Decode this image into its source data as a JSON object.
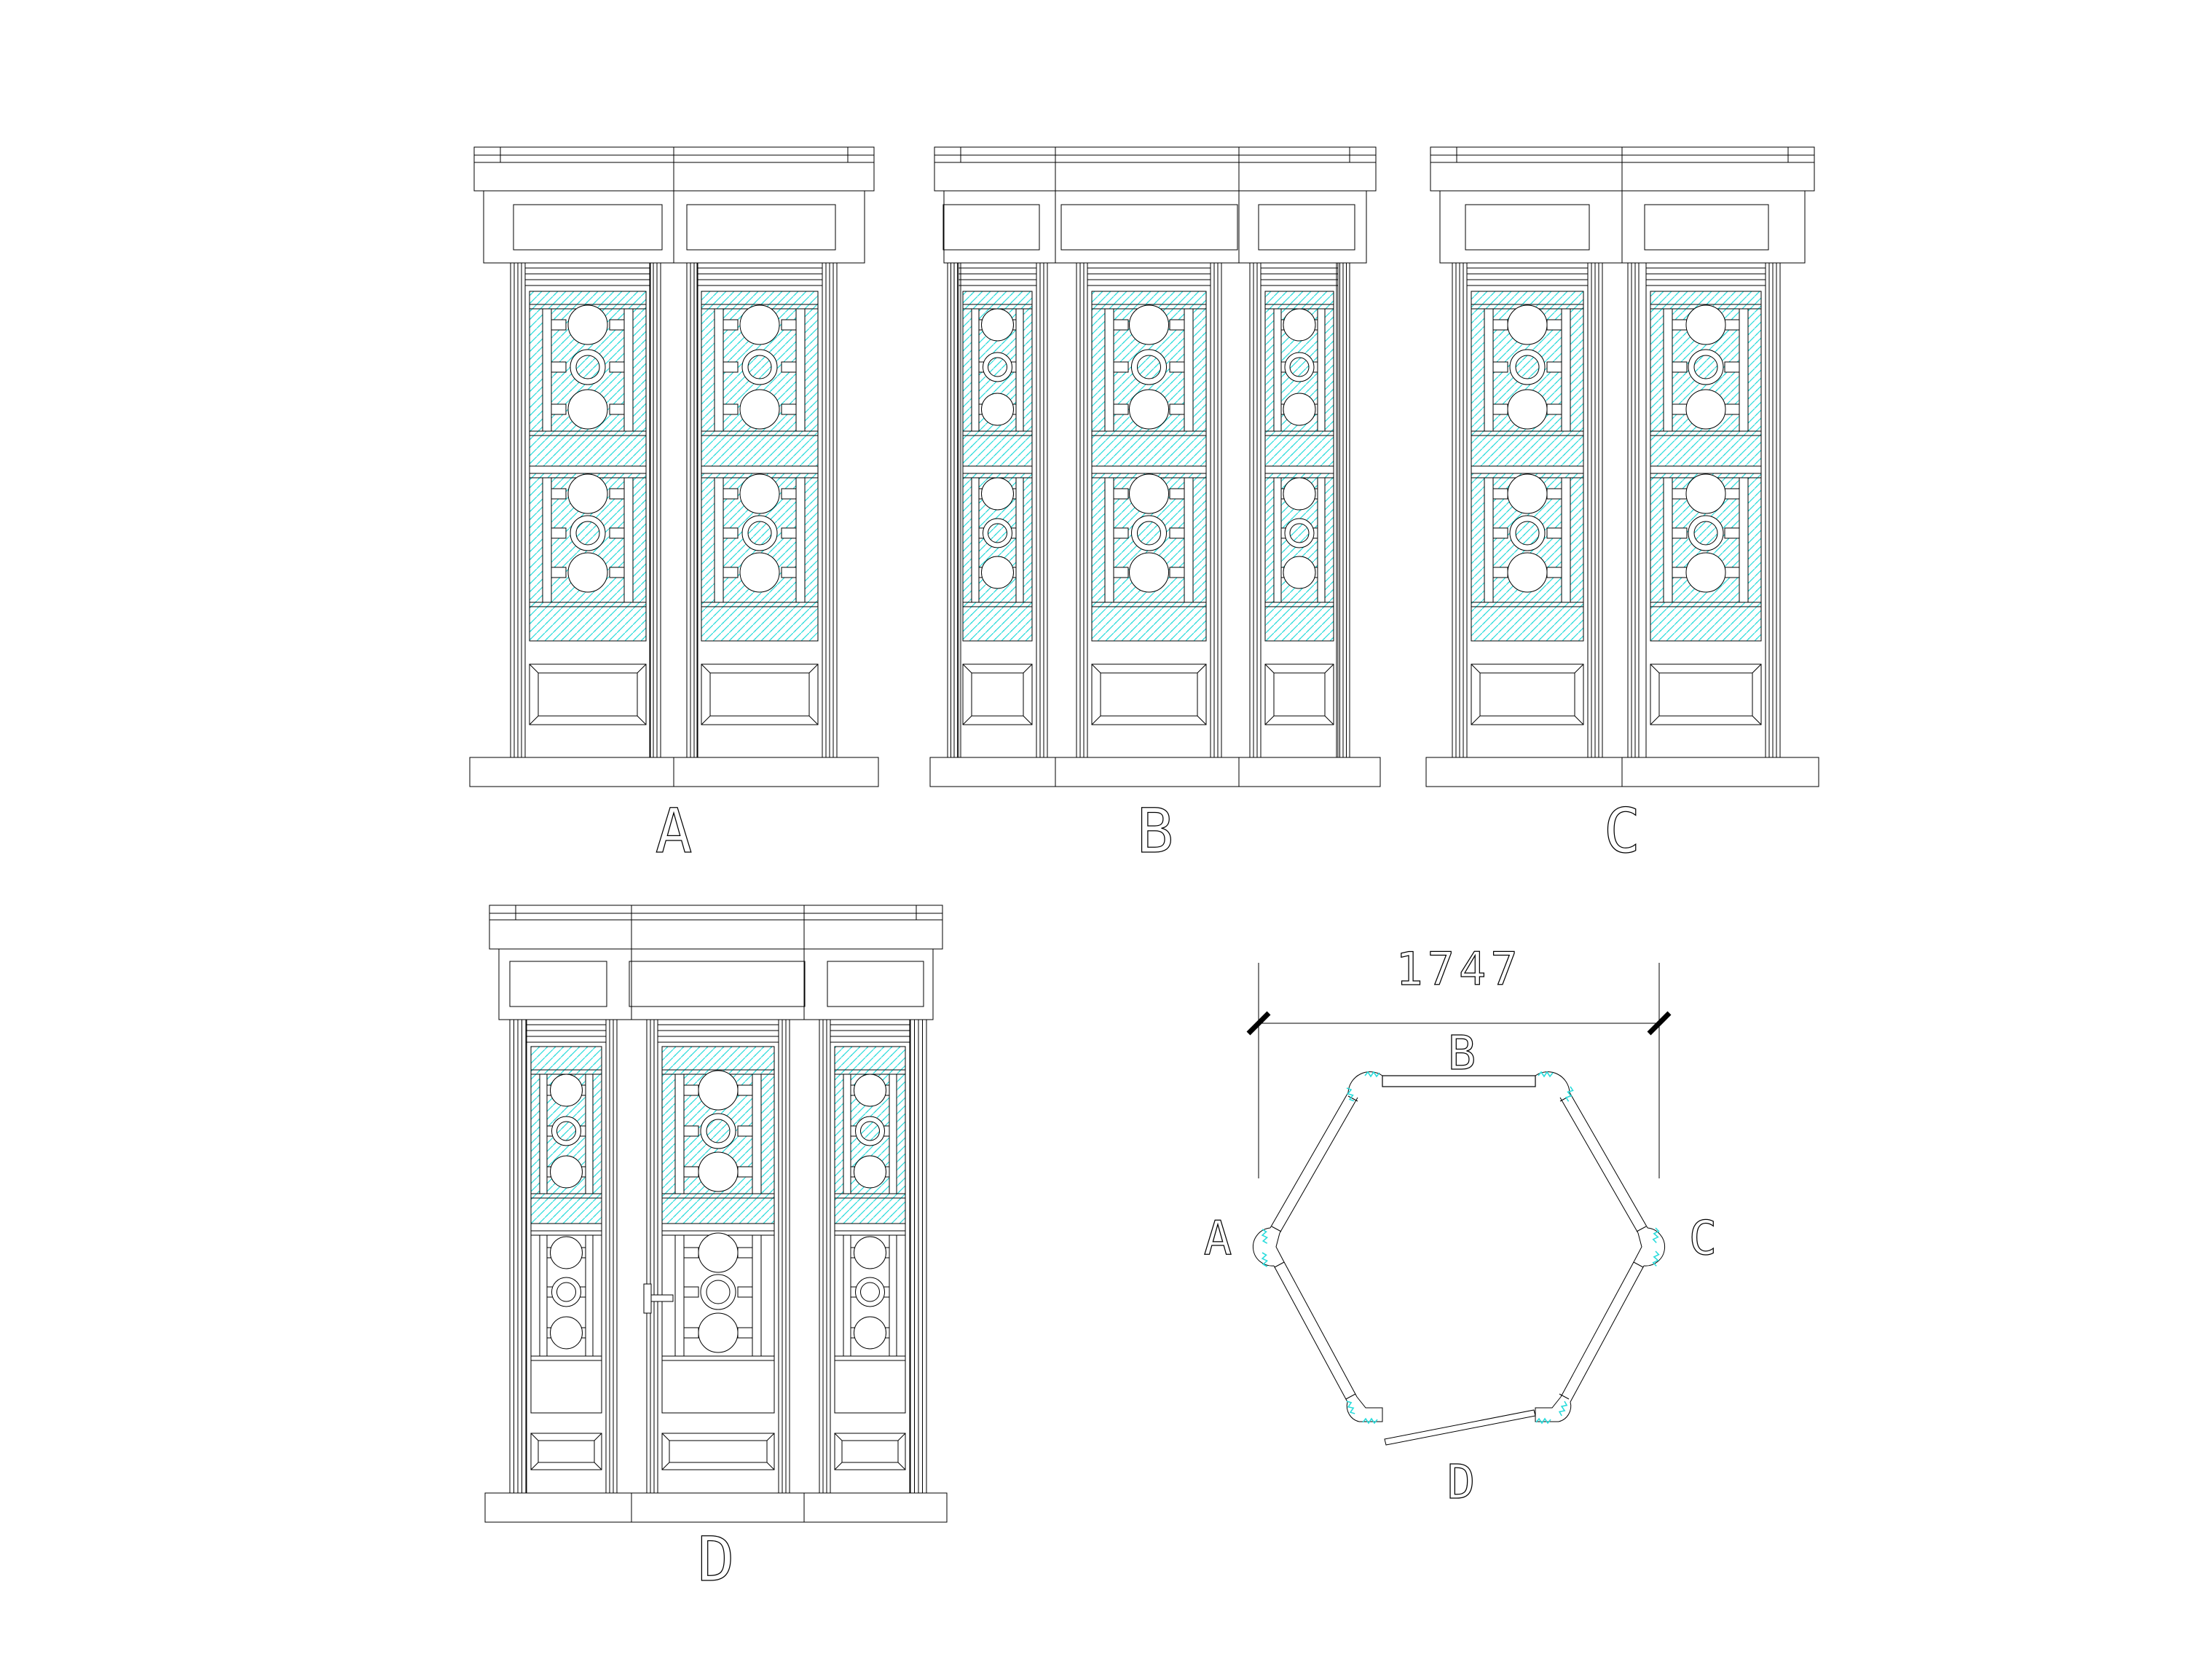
{
  "colors": {
    "line": "#000000",
    "hatch_cyan": "#2bdcdc",
    "paper": "#ffffff"
  },
  "elevations": [
    {
      "id": "A",
      "label": "A",
      "leaf_count": 2
    },
    {
      "id": "B",
      "label": "B",
      "leaf_count": 3
    },
    {
      "id": "C",
      "label": "C",
      "leaf_count": 2
    },
    {
      "id": "D",
      "label": "D",
      "leaf_count": 3
    }
  ],
  "plan": {
    "dimension_label": "1747",
    "wall_labels": {
      "top": "B",
      "left": "A",
      "right": "C",
      "bottom": "D"
    }
  }
}
